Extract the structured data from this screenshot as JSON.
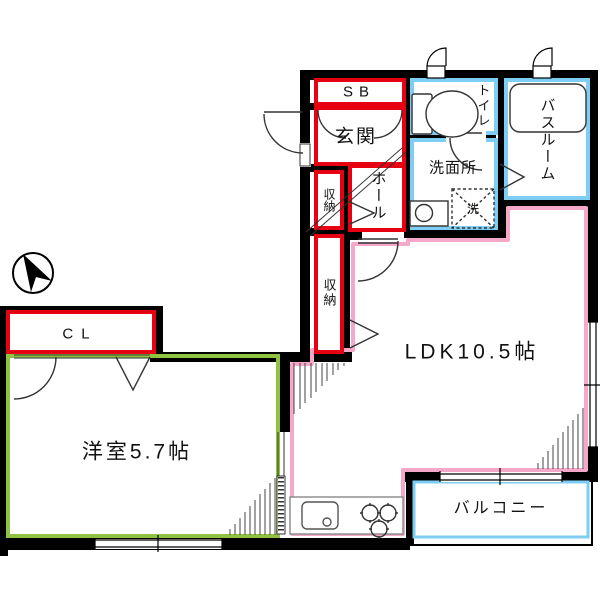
{
  "floorplan": {
    "rooms": {
      "sb": {
        "label": "SB"
      },
      "genkan": {
        "label": "玄関"
      },
      "storage_upper": {
        "label": "収納"
      },
      "hall": {
        "label": "ホール"
      },
      "toilet": {
        "label": "トイレ"
      },
      "bathroom": {
        "label": "バスルーム"
      },
      "washroom": {
        "label": "洗面所"
      },
      "washer": {
        "label": "洗"
      },
      "storage_lower": {
        "label": "収納"
      },
      "closet": {
        "label": "CL"
      },
      "ldk": {
        "label": "LDK10.5帖"
      },
      "western_room": {
        "label": "洋室5.7帖"
      },
      "balcony": {
        "label": "バルコニー"
      }
    },
    "colors": {
      "entry_storage_outline": "#e60012",
      "wet_area_outline": "#7ecef4",
      "ldk_outline": "#f5a8c7",
      "western_room_outline": "#8fc341",
      "wall": "#000000"
    }
  }
}
